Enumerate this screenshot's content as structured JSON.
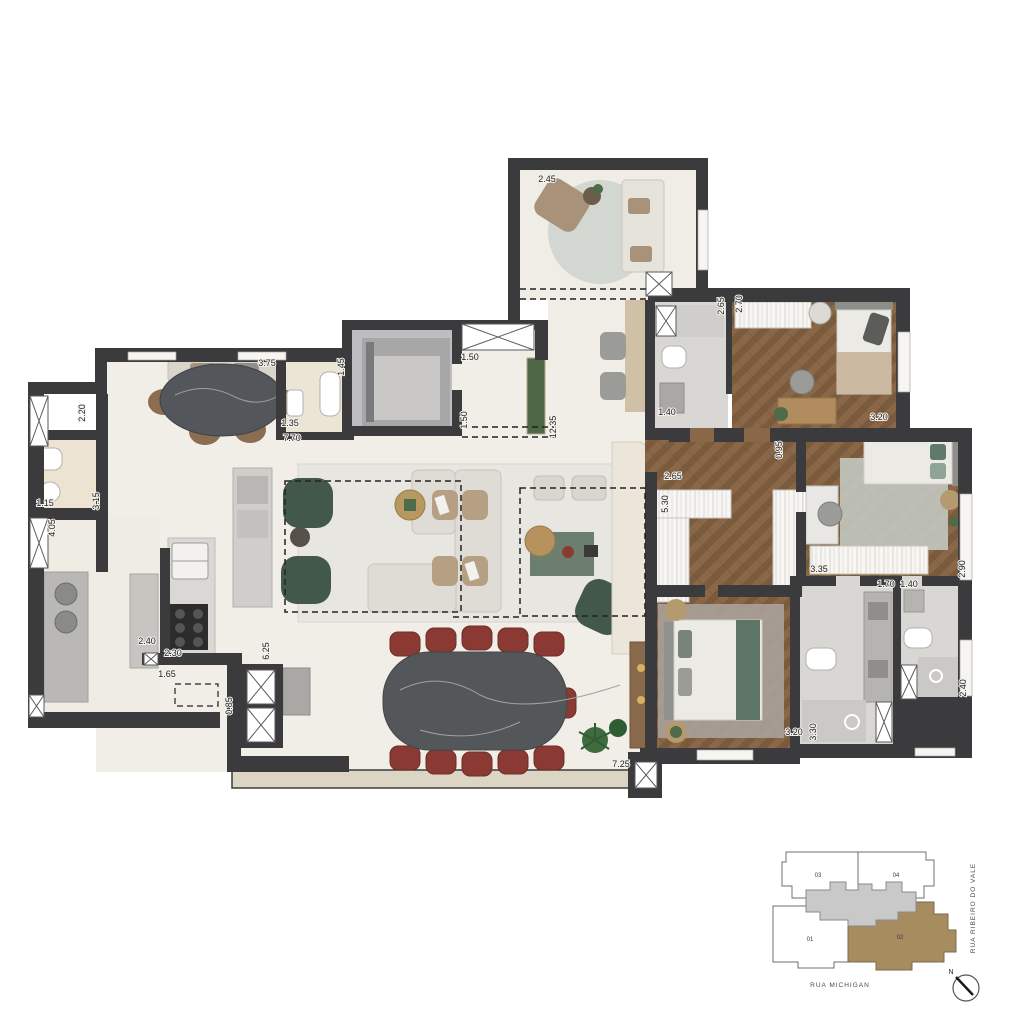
{
  "floorplan": {
    "dimension_labels": [
      {
        "value": "2.45",
        "x": 547,
        "y": 182,
        "rot": 0
      },
      {
        "value": "3.75",
        "x": 267,
        "y": 366,
        "rot": 0
      },
      {
        "value": "1.45",
        "x": 344,
        "y": 367,
        "rot": -90
      },
      {
        "value": "1.50",
        "x": 470,
        "y": 360,
        "rot": 0
      },
      {
        "value": "1.50",
        "x": 467,
        "y": 420,
        "rot": -90
      },
      {
        "value": "12.35",
        "x": 556,
        "y": 427,
        "rot": -90
      },
      {
        "value": "1.35",
        "x": 290,
        "y": 426,
        "rot": 0
      },
      {
        "value": "7.70",
        "x": 292,
        "y": 441,
        "rot": 0
      },
      {
        "value": "2.20",
        "x": 85,
        "y": 413,
        "rot": -90
      },
      {
        "value": "1.15",
        "x": 45,
        "y": 506,
        "rot": 0
      },
      {
        "value": "3.15",
        "x": 99,
        "y": 501,
        "rot": -90
      },
      {
        "value": "4.05",
        "x": 55,
        "y": 528,
        "rot": -90
      },
      {
        "value": "2.40",
        "x": 147,
        "y": 644,
        "rot": 0
      },
      {
        "value": "2.30",
        "x": 173,
        "y": 656,
        "rot": 0
      },
      {
        "value": "1.65",
        "x": 167,
        "y": 677,
        "rot": 0
      },
      {
        "value": "6.25",
        "x": 269,
        "y": 651,
        "rot": -90
      },
      {
        "value": "0.85",
        "x": 232,
        "y": 706,
        "rot": -90
      },
      {
        "value": "7.25",
        "x": 621,
        "y": 767,
        "rot": 0
      },
      {
        "value": "2.65",
        "x": 724,
        "y": 306,
        "rot": -90
      },
      {
        "value": "2.70",
        "x": 742,
        "y": 304,
        "rot": -90
      },
      {
        "value": "1.40",
        "x": 667,
        "y": 415,
        "rot": 0
      },
      {
        "value": "3.20",
        "x": 879,
        "y": 420,
        "rot": 0
      },
      {
        "value": "2.65",
        "x": 673,
        "y": 479,
        "rot": 0
      },
      {
        "value": "0.95",
        "x": 782,
        "y": 450,
        "rot": -90
      },
      {
        "value": "5.30",
        "x": 668,
        "y": 504,
        "rot": -90
      },
      {
        "value": "3.35",
        "x": 819,
        "y": 572,
        "rot": 0
      },
      {
        "value": "2.90",
        "x": 965,
        "y": 569,
        "rot": -90
      },
      {
        "value": "1.70",
        "x": 886,
        "y": 587,
        "rot": 0
      },
      {
        "value": "1.40",
        "x": 909,
        "y": 587,
        "rot": 0
      },
      {
        "value": "2.40",
        "x": 966,
        "y": 688,
        "rot": -90
      },
      {
        "value": "3.20",
        "x": 794,
        "y": 735,
        "rot": 0
      },
      {
        "value": "3.30",
        "x": 816,
        "y": 732,
        "rot": -90
      }
    ],
    "colors": {
      "wall": "#3b3b3d",
      "floor_light": "#f1eee8",
      "floor_service": "#ece3d1",
      "wood": "#8a6747",
      "tile_gray": "#d8d7d4",
      "hall_gray": "#bebec0",
      "green_chair": "#41584a",
      "red_chair": "#8a3a33",
      "marble_dark": "#54575a",
      "keyplan_highlight": "#a78c5f"
    }
  },
  "keyplan": {
    "units": [
      {
        "label": "03"
      },
      {
        "label": "04"
      },
      {
        "label": "01"
      },
      {
        "label": "02",
        "highlighted": true
      }
    ],
    "street_right": "RUA RIBEIRO DO VALE",
    "street_bottom": "RUA MICHIGAN",
    "compass_label": "N"
  }
}
